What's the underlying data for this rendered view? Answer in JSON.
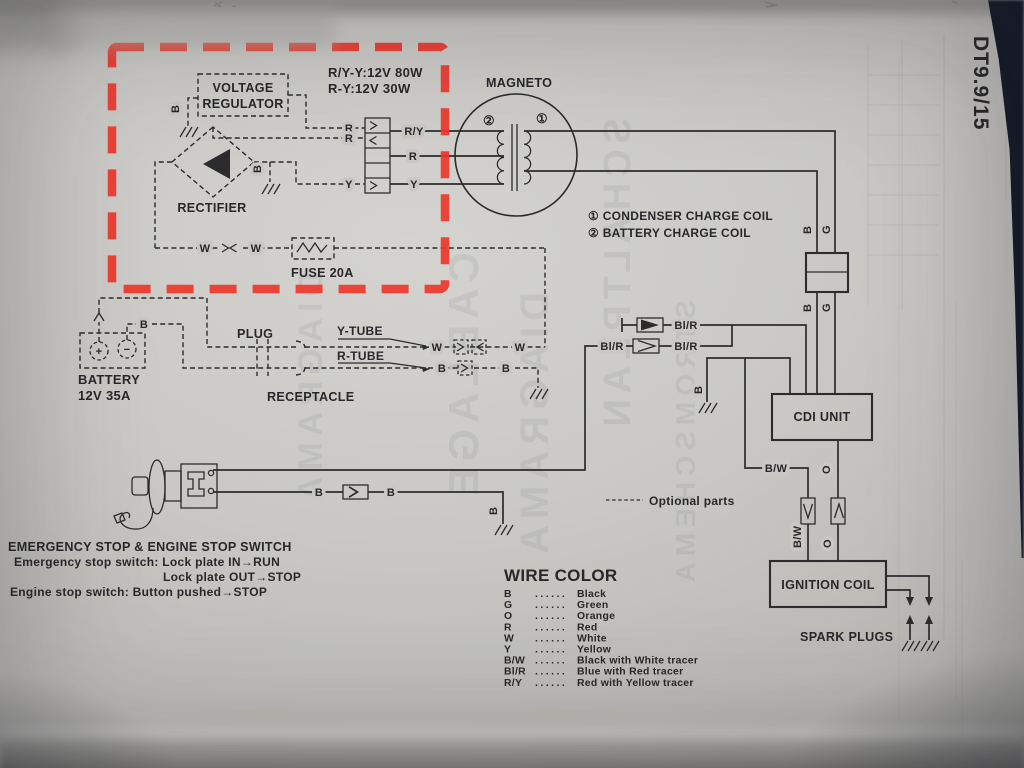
{
  "page": {
    "tag": "DT9.9/15"
  },
  "wires": {
    "r": "R",
    "y": "Y",
    "w": "W",
    "b": "B",
    "g": "G",
    "o": "O",
    "ry": "R/Y",
    "bw": "B/W",
    "blr": "Bl/R"
  },
  "charging": {
    "spec1": "R/Y-Y:12V 80W",
    "spec2": "R-Y:12V 30W",
    "regulator_line1": "VOLTAGE",
    "regulator_line2": "REGULATOR",
    "rectifier": "RECTIFIER",
    "fuse": "FUSE 20A"
  },
  "magneto": {
    "title": "MAGNETO",
    "num1": "①",
    "num2": "②",
    "legend1": "① CONDENSER CHARGE COIL",
    "legend2": "② BATTERY CHARGE COIL"
  },
  "battery": {
    "name": "BATTERY",
    "rating": "12V 35A",
    "plus": "+",
    "minus": "−",
    "plug": "PLUG",
    "receptacle": "RECEPTACLE",
    "y_tube": "Y-TUBE",
    "r_tube": "R-TUBE"
  },
  "units": {
    "cdi": "CDI UNIT",
    "ignition_coil": "IGNITION COIL",
    "spark_plugs": "SPARK PLUGS"
  },
  "stop_switch": {
    "title": "EMERGENCY STOP & ENGINE STOP SWITCH",
    "line1": "Emergency stop switch: Lock plate IN→RUN",
    "line2": "Lock plate OUT→STOP",
    "line3": "Engine stop switch: Button pushed→STOP"
  },
  "notes": {
    "optional_parts": "Optional parts"
  },
  "wire_color": {
    "title": "WIRE COLOR",
    "dots": "......",
    "rows": [
      {
        "code": "B",
        "name": "Black"
      },
      {
        "code": "G",
        "name": "Green"
      },
      {
        "code": "O",
        "name": "Orange"
      },
      {
        "code": "R",
        "name": "Red"
      },
      {
        "code": "W",
        "name": "White"
      },
      {
        "code": "Y",
        "name": "Yellow"
      },
      {
        "code": "B/W",
        "name": "Black with White tracer"
      },
      {
        "code": "Bl/R",
        "name": "Blue with Red tracer"
      },
      {
        "code": "R/Y",
        "name": "Red with Yellow tracer"
      }
    ]
  },
  "annotation": {
    "highlight_color": "#ee372b",
    "ink_color": "#2c2c2e",
    "page_color": "#c9c8c4"
  },
  "bleedthrough": {
    "w1": "DIAGRAMA",
    "w2": "CABLAGE",
    "w3": "DIAGRAMA",
    "w4": "SCHALTPLAN",
    "w5": "STROMSCHEMA"
  }
}
